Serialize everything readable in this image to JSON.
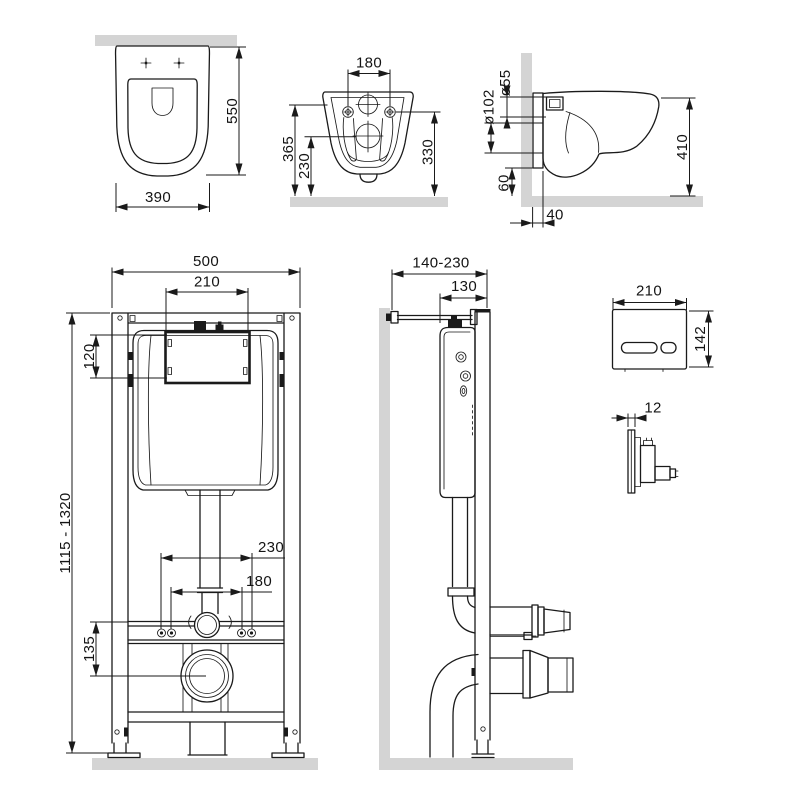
{
  "drawing": {
    "kind": "wall-hung toilet and concealed installation frame dimensional drawing",
    "colors": {
      "line": "#1a1a1a",
      "surface_fill": "#d4d4d4",
      "background": "#ffffff"
    }
  },
  "views": {
    "bowl_top": {
      "dims": {
        "depth": "550",
        "width": "390"
      }
    },
    "bowl_back": {
      "dims": {
        "bolt_spacing": "180",
        "height_overall": "365",
        "height_outlet": "230",
        "height_rim": "330"
      }
    },
    "bowl_side": {
      "dims": {
        "inlet_diameter": "ø55",
        "outlet_diameter": "ø102",
        "depth": "410",
        "bottom_clearance": "60",
        "wall_offset": "40"
      }
    },
    "frame_front": {
      "dims": {
        "width": "500",
        "window_width": "210",
        "window_height": "120",
        "height_range": "1115 - 1320",
        "stud_spacing_outer": "230",
        "stud_spacing_inner": "180",
        "outlet_drop": "135"
      }
    },
    "frame_side": {
      "dims": {
        "depth_range": "140-230",
        "frame_depth": "130"
      }
    },
    "plate_front": {
      "dims": {
        "width": "210",
        "height": "142"
      }
    },
    "plate_side": {
      "dims": {
        "thickness": "12"
      }
    }
  }
}
